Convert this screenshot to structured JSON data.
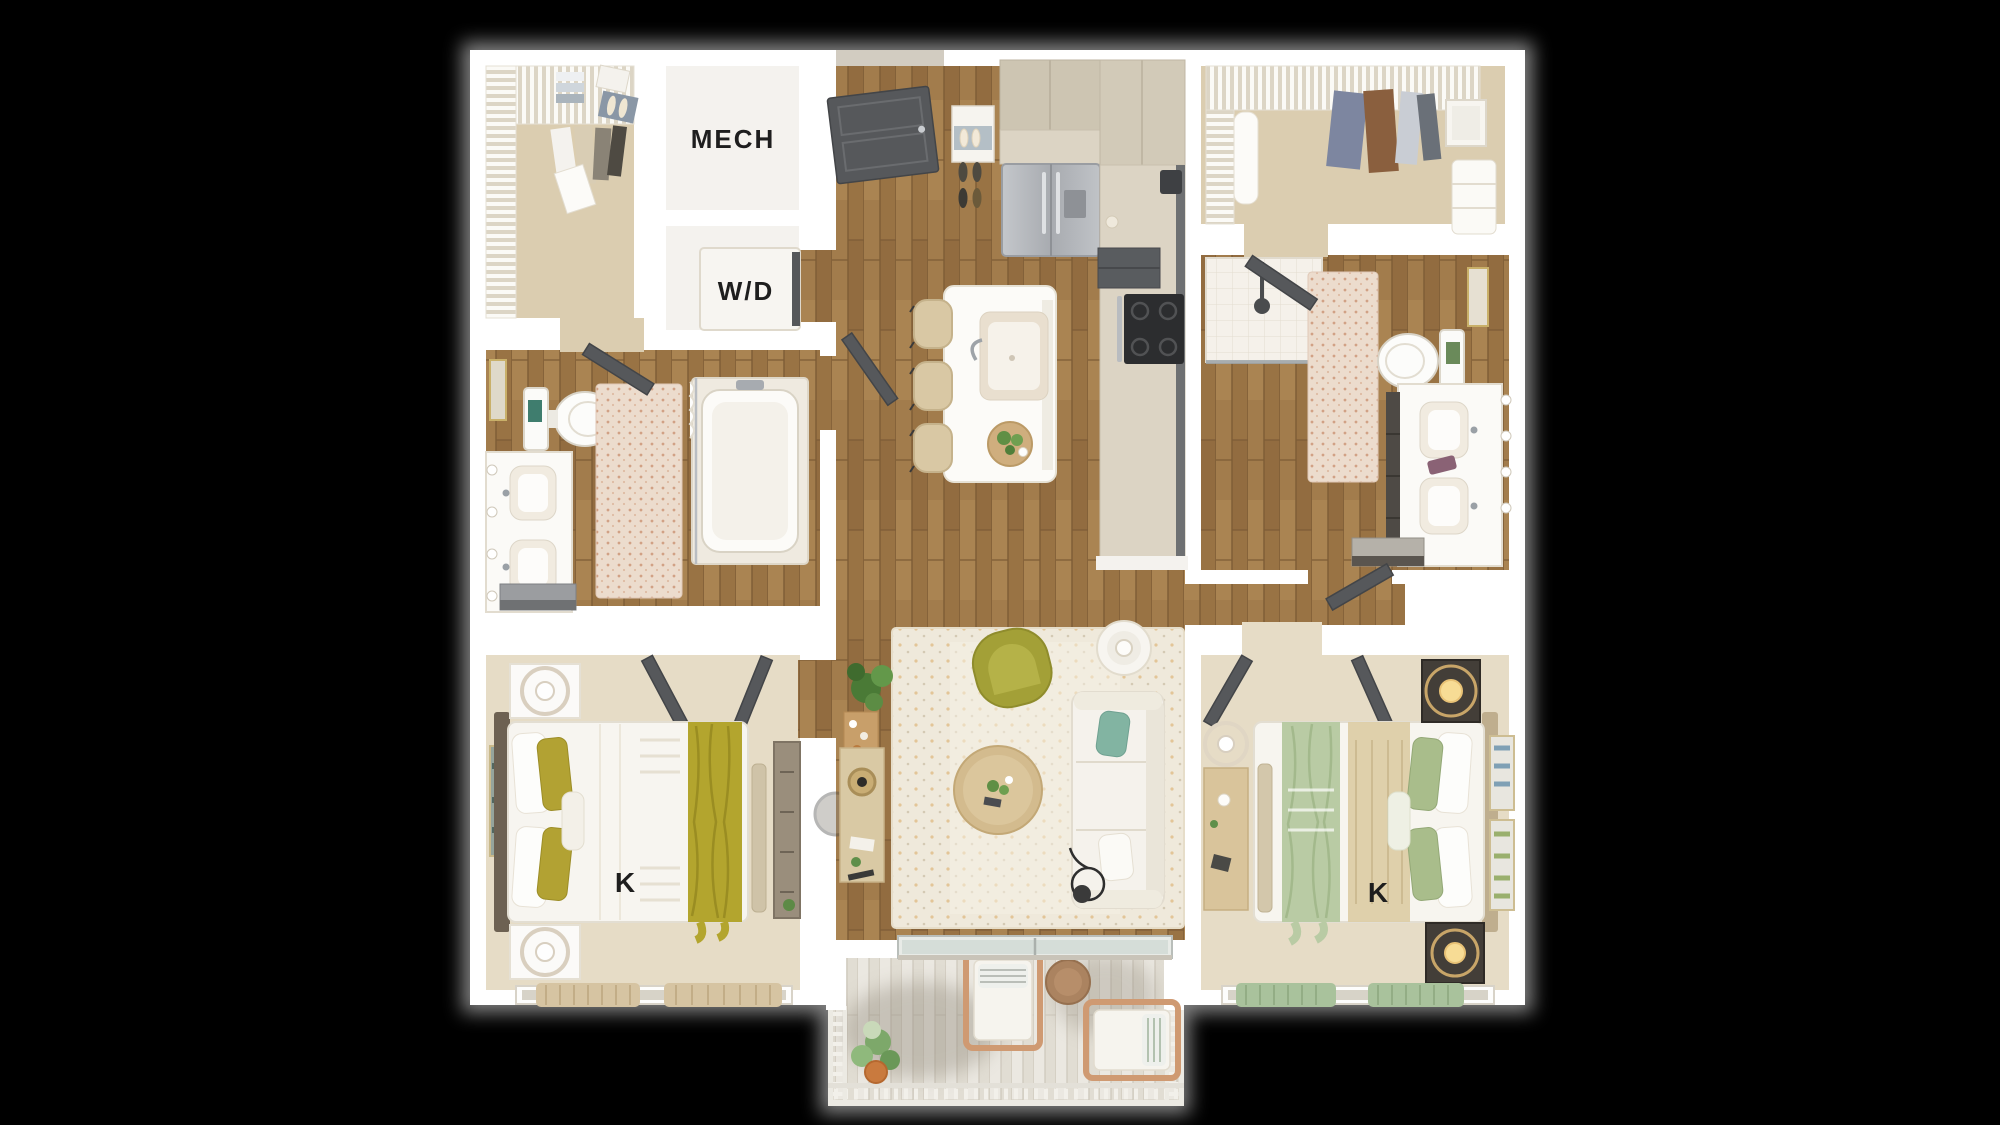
{
  "scene": {
    "description": "Top-down 3D render of a two-bedroom, two-bath apartment floor plan with balcony on black background"
  },
  "labels": {
    "mech_room": "MECH",
    "washer_dryer": "W/D",
    "bedroom_left_bed": "K",
    "bedroom_right_bed": "K"
  },
  "colors": {
    "background": "#000000",
    "walls": "#ffffff",
    "wood_floor": "#a27c4c",
    "bedroom_carpet": "#e6dcc6",
    "closet_carpet": "#dbcdb0",
    "accent_olive": "#a8a434",
    "accent_sage": "#a9bd8b",
    "accent_teal": "#82b4a2",
    "door_gray": "#56585b",
    "counter_beige": "#dcd4c4",
    "balcony_deck": "#ebe8e1"
  }
}
